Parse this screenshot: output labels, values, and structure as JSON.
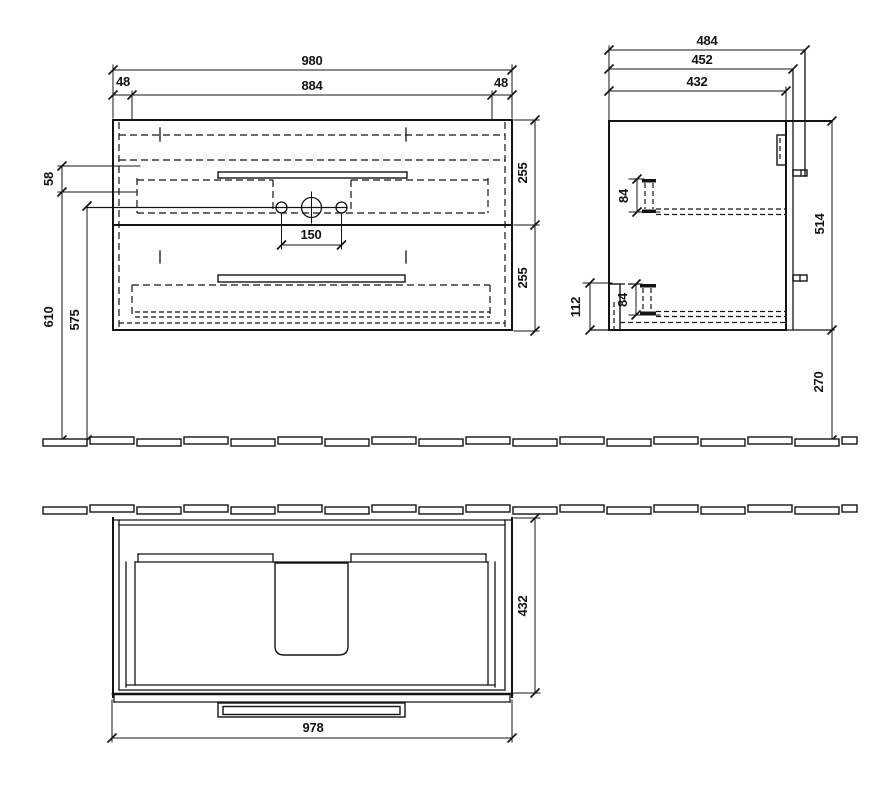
{
  "front_view": {
    "total_width": "980",
    "side_panel_left": "48",
    "drawer_front_width": "884",
    "side_panel_right": "48",
    "rim_offset": "58",
    "height_to_top": "610",
    "height_to_rim": "575",
    "upper_drawer_height": "255",
    "lower_drawer_height": "255",
    "tap_hole_spacing": "150"
  },
  "side_view": {
    "total_depth": "484",
    "depth_with_rail": "452",
    "body_depth": "432",
    "upper_bracket_height": "84",
    "lower_bracket_height": "84",
    "front_drop": "112",
    "body_height": "514",
    "floor_clearance": "270"
  },
  "top_view": {
    "depth": "432",
    "width": "978"
  }
}
